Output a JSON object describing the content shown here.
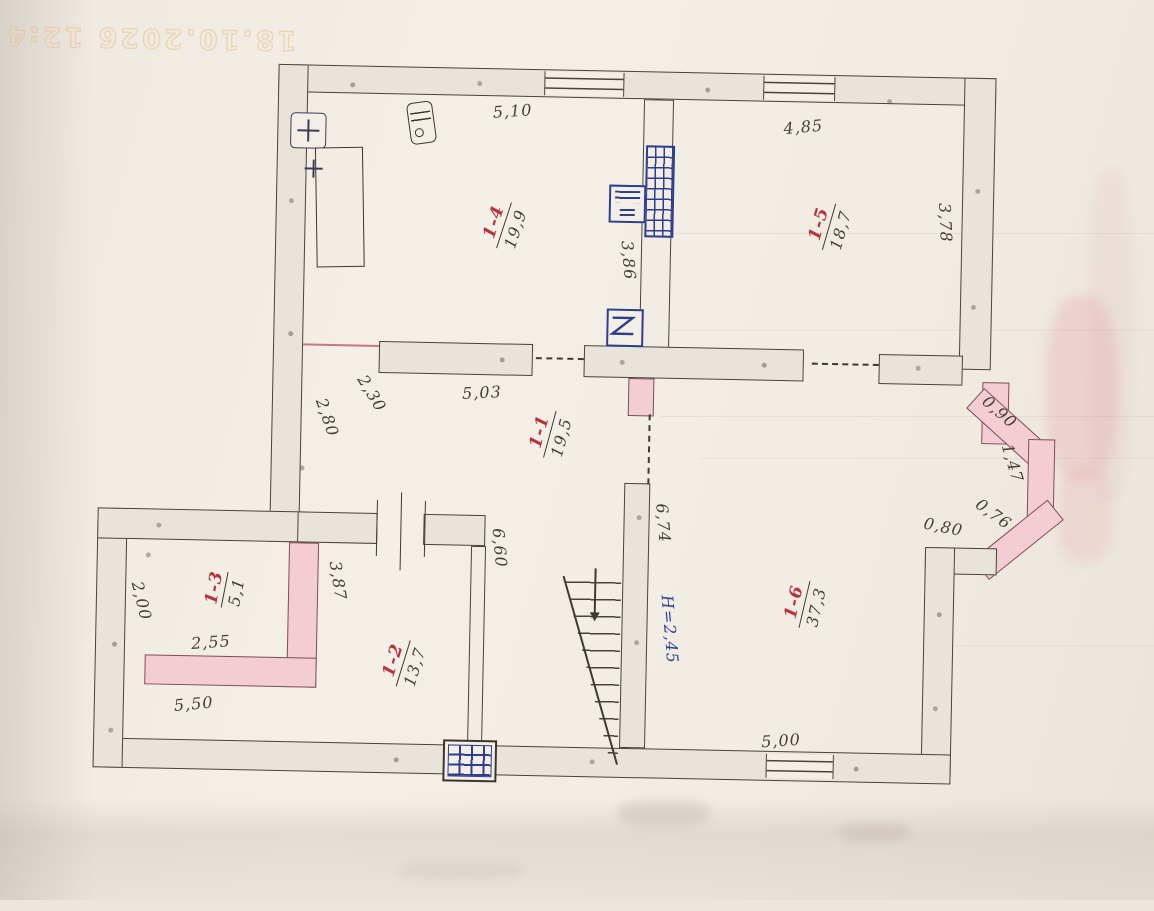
{
  "watermark": "18.10.2026 12:4",
  "rooms": {
    "r11": {
      "number": "1-1",
      "area": "19,5"
    },
    "r12": {
      "number": "1-2",
      "area": "13,7"
    },
    "r13": {
      "number": "1-3",
      "area": "5,1"
    },
    "r14": {
      "number": "1-4",
      "area": "19,9"
    },
    "r15": {
      "number": "1-5",
      "area": "18,7"
    },
    "r16": {
      "number": "1-6",
      "area": "37,3"
    }
  },
  "dims": {
    "top_room14": "5,10",
    "top_room15": "4,85",
    "right_room15": "3,78",
    "partition_room14": "3,86",
    "inner_wall": "5,03",
    "offset_230": "2,30",
    "left_room11": "2,80",
    "bay_seg1": "0,90",
    "bay_seg2": "1,47",
    "bay_seg3": "0,76",
    "bay_seg4": "0,80",
    "stair_wall": "6,74",
    "stair_height_note": "H=2,45",
    "bottom_room16": "5,00",
    "annex_right": "3,87",
    "annex_left": "2,00",
    "room13_width": "2,55",
    "annex_width": "5,50",
    "room12_wall": "6,60"
  },
  "colors": {
    "paper": "#f1ece3",
    "wall_fill": "#e9e4d9",
    "pink_wall": "#f4ccd3",
    "red_label": "#b5323e",
    "blue_ink": "#2f3d8f",
    "pencil": "#463f35"
  }
}
